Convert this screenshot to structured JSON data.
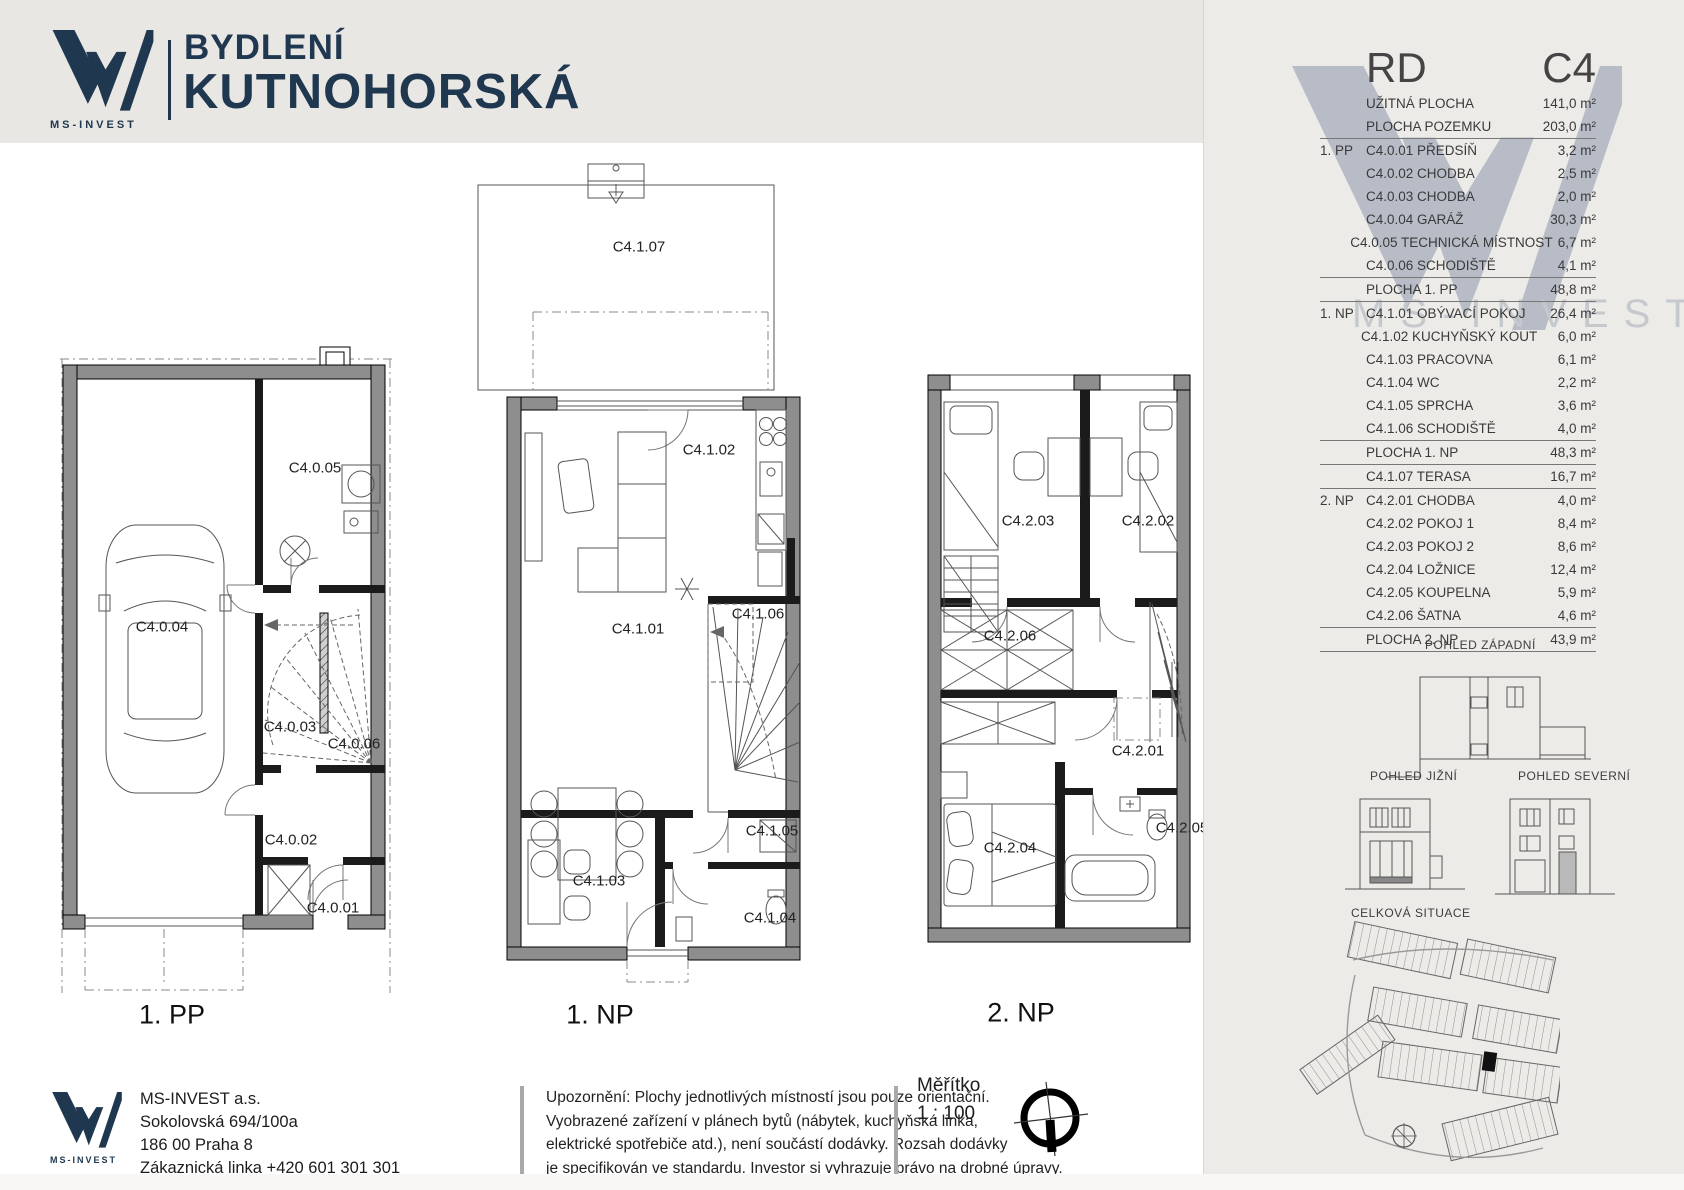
{
  "header": {
    "logo_text": "MS-INVEST",
    "brand_line1": "BYDLENÍ",
    "brand_line2": "KUTNOHORSKÁ"
  },
  "plans": {
    "pp1": {
      "label": "1. PP",
      "rooms": {
        "r1": "C4.0.01",
        "r2": "C4.0.02",
        "r3": "C4.0.03",
        "r4": "C4.0.04",
        "r5": "C4.0.05",
        "r6": "C4.0.06"
      }
    },
    "np1": {
      "label": "1. NP",
      "rooms": {
        "r1": "C4.1.01",
        "r2": "C4.1.02",
        "r3": "C4.1.03",
        "r4": "C4.1.04",
        "r5": "C4.1.05",
        "r6": "C4.1.06",
        "r7": "C4.1.07"
      }
    },
    "np2": {
      "label": "2. NP",
      "rooms": {
        "r1": "C4.2.01",
        "r2": "C4.2.02",
        "r3": "C4.2.03",
        "r4": "C4.2.04",
        "r5": "C4.2.05",
        "r6": "C4.2.06"
      }
    }
  },
  "sidebar": {
    "unit_type": "RD",
    "unit_code": "C4",
    "watermark_text": "MS-INVEST",
    "rows": [
      {
        "level": "",
        "name": "UŽITNÁ PLOCHA",
        "value": "141,0 m²",
        "cls": ""
      },
      {
        "level": "",
        "name": "PLOCHA POZEMKU",
        "value": "203,0 m²",
        "cls": "end"
      },
      {
        "level": "1. PP",
        "name": "C4.0.01 PŘEDSÍŇ",
        "value": "3,2 m²",
        "cls": ""
      },
      {
        "level": "",
        "name": "C4.0.02 CHODBA",
        "value": "2,5 m²",
        "cls": ""
      },
      {
        "level": "",
        "name": "C4.0.03 CHODBA",
        "value": "2,0 m²",
        "cls": ""
      },
      {
        "level": "",
        "name": "C4.0.04 GARÁŽ",
        "value": "30,3 m²",
        "cls": ""
      },
      {
        "level": "",
        "name": "C4.0.05 TECHNICKÁ MÍSTNOST",
        "value": "6,7 m²",
        "cls": ""
      },
      {
        "level": "",
        "name": "C4.0.06 SCHODIŠTĚ",
        "value": "4,1 m²",
        "cls": ""
      },
      {
        "level": "",
        "name": "PLOCHA 1. PP",
        "value": "48,8 m²",
        "cls": "sum"
      },
      {
        "level": "1. NP",
        "name": "C4.1.01 OBÝVACÍ POKOJ",
        "value": "26,4 m²",
        "cls": ""
      },
      {
        "level": "",
        "name": "C4.1.02 KUCHYŇSKÝ KOUT",
        "value": "6,0 m²",
        "cls": ""
      },
      {
        "level": "",
        "name": "C4.1.03 PRACOVNA",
        "value": "6,1 m²",
        "cls": ""
      },
      {
        "level": "",
        "name": "C4.1.04 WC",
        "value": "2,2 m²",
        "cls": ""
      },
      {
        "level": "",
        "name": "C4.1.05 SPRCHA",
        "value": "3,6 m²",
        "cls": ""
      },
      {
        "level": "",
        "name": "C4.1.06 SCHODIŠTĚ",
        "value": "4,0 m²",
        "cls": ""
      },
      {
        "level": "",
        "name": "PLOCHA 1. NP",
        "value": "48,3 m²",
        "cls": "sum"
      },
      {
        "level": "",
        "name": "C4.1.07 TERASA",
        "value": "16,7 m²",
        "cls": "end"
      },
      {
        "level": "2. NP",
        "name": "C4.2.01 CHODBA",
        "value": "4,0 m²",
        "cls": ""
      },
      {
        "level": "",
        "name": "C4.2.02 POKOJ 1",
        "value": "8,4 m²",
        "cls": ""
      },
      {
        "level": "",
        "name": "C4.2.03 POKOJ 2",
        "value": "8,6 m²",
        "cls": ""
      },
      {
        "level": "",
        "name": "C4.2.04 LOŽNICE",
        "value": "12,4 m²",
        "cls": ""
      },
      {
        "level": "",
        "name": "C4.2.05 KOUPELNA",
        "value": "5,9 m²",
        "cls": ""
      },
      {
        "level": "",
        "name": "C4.2.06 ŠATNA",
        "value": "4,6 m²",
        "cls": ""
      },
      {
        "level": "",
        "name": "PLOCHA 2. NP",
        "value": "43,9 m²",
        "cls": "sum"
      }
    ],
    "elevation_west": "POHLED ZÁPADNÍ",
    "elevation_south": "POHLED JIŽNÍ",
    "elevation_north": "POHLED SEVERNÍ",
    "site_label": "CELKOVÁ SITUACE"
  },
  "footer": {
    "logo_text": "MS-INVEST",
    "company": "MS-INVEST  a.s.",
    "address_line1": "Sokolovská 694/100a",
    "address_line2": "186 00 Praha 8",
    "address_line3": "Zákaznická linka +420 601 301 301",
    "disclaimer_line1": "Upozornění: Plochy jednotlivých místností jsou pouze orientační.",
    "disclaimer_line2": "Vyobrazené zařízení v plánech bytů (nábytek, kuchyňská linka,",
    "disclaimer_line3": "elektrické spotřebiče atd.), není součástí dodávky. Rozsah dodávky",
    "disclaimer_line4": "je specifikován ve standardu. Investor si vyhrazuje právo na drobné úpravy.",
    "scale_label": "Měřítko",
    "scale_value": "1 : 100"
  },
  "colors": {
    "brand_navy": "#20384f",
    "watermark_gray": "#aab1bf",
    "wall_gray": "#8e8e8e"
  }
}
